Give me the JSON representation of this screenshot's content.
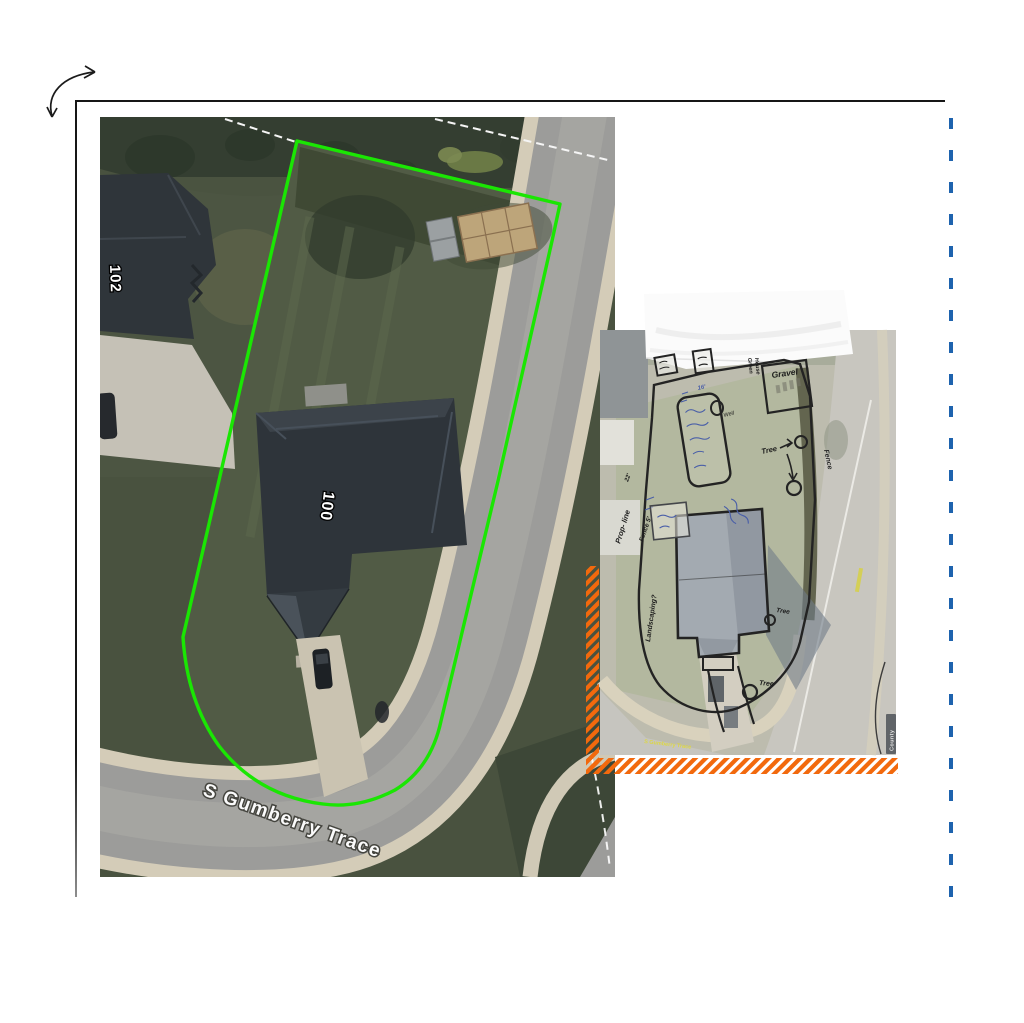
{
  "canvas": {
    "background": "#ffffff"
  },
  "icons": {
    "rotate_arrow": "curved-double-arrow",
    "page_border": "l-shaped-frame",
    "page_break": "vertical-dashed-divider"
  },
  "main_map": {
    "house_number_neighbor": "102",
    "house_number_subject": "100",
    "street_name": "S Gumberry Trace",
    "boundary_color": "#1ae603",
    "parcel_line_color": "#f5f5f5"
  },
  "sketch_map": {
    "gravel_label": "Gravel",
    "green_house_line1": "Green",
    "green_house_line2": "House",
    "well_label": "Well",
    "tree_label": "Tree",
    "fence_label": "Fence",
    "prop_line_label": "Prop- line",
    "fence_height_label": "Fence 5'",
    "dim_22": "22'",
    "dim_16": "16'",
    "landscaping_label": "Landscaping?",
    "road_label": "S Gumberry Trace",
    "county_badge": "County",
    "hatch_color": "#f2690d"
  },
  "divider": {
    "color": "#1e63ae"
  }
}
